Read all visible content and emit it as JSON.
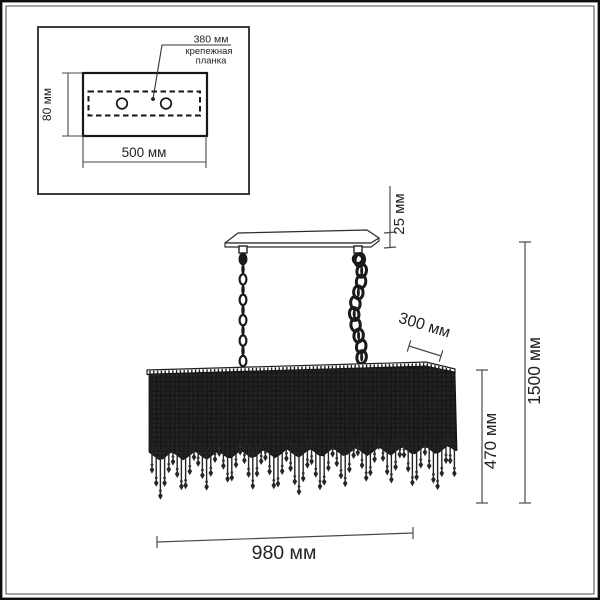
{
  "inset": {
    "bracket_length": "380 мм",
    "bracket_name_line1": "крепежная",
    "bracket_name_line2": "планка",
    "plate_height": "80 мм",
    "plate_width": "500 мм"
  },
  "dimensions": {
    "canopy_thickness": "25 мм",
    "shade_depth": "300 мм",
    "total_height": "1500 мм",
    "shade_height": "470 мм",
    "shade_width": "980 мм"
  },
  "colors": {
    "ink": "#1a1a1a",
    "dim_line": "#4a4a4a",
    "mass_dark": "#191919",
    "bead_highlight": "#323232",
    "background": "#ffffff"
  }
}
